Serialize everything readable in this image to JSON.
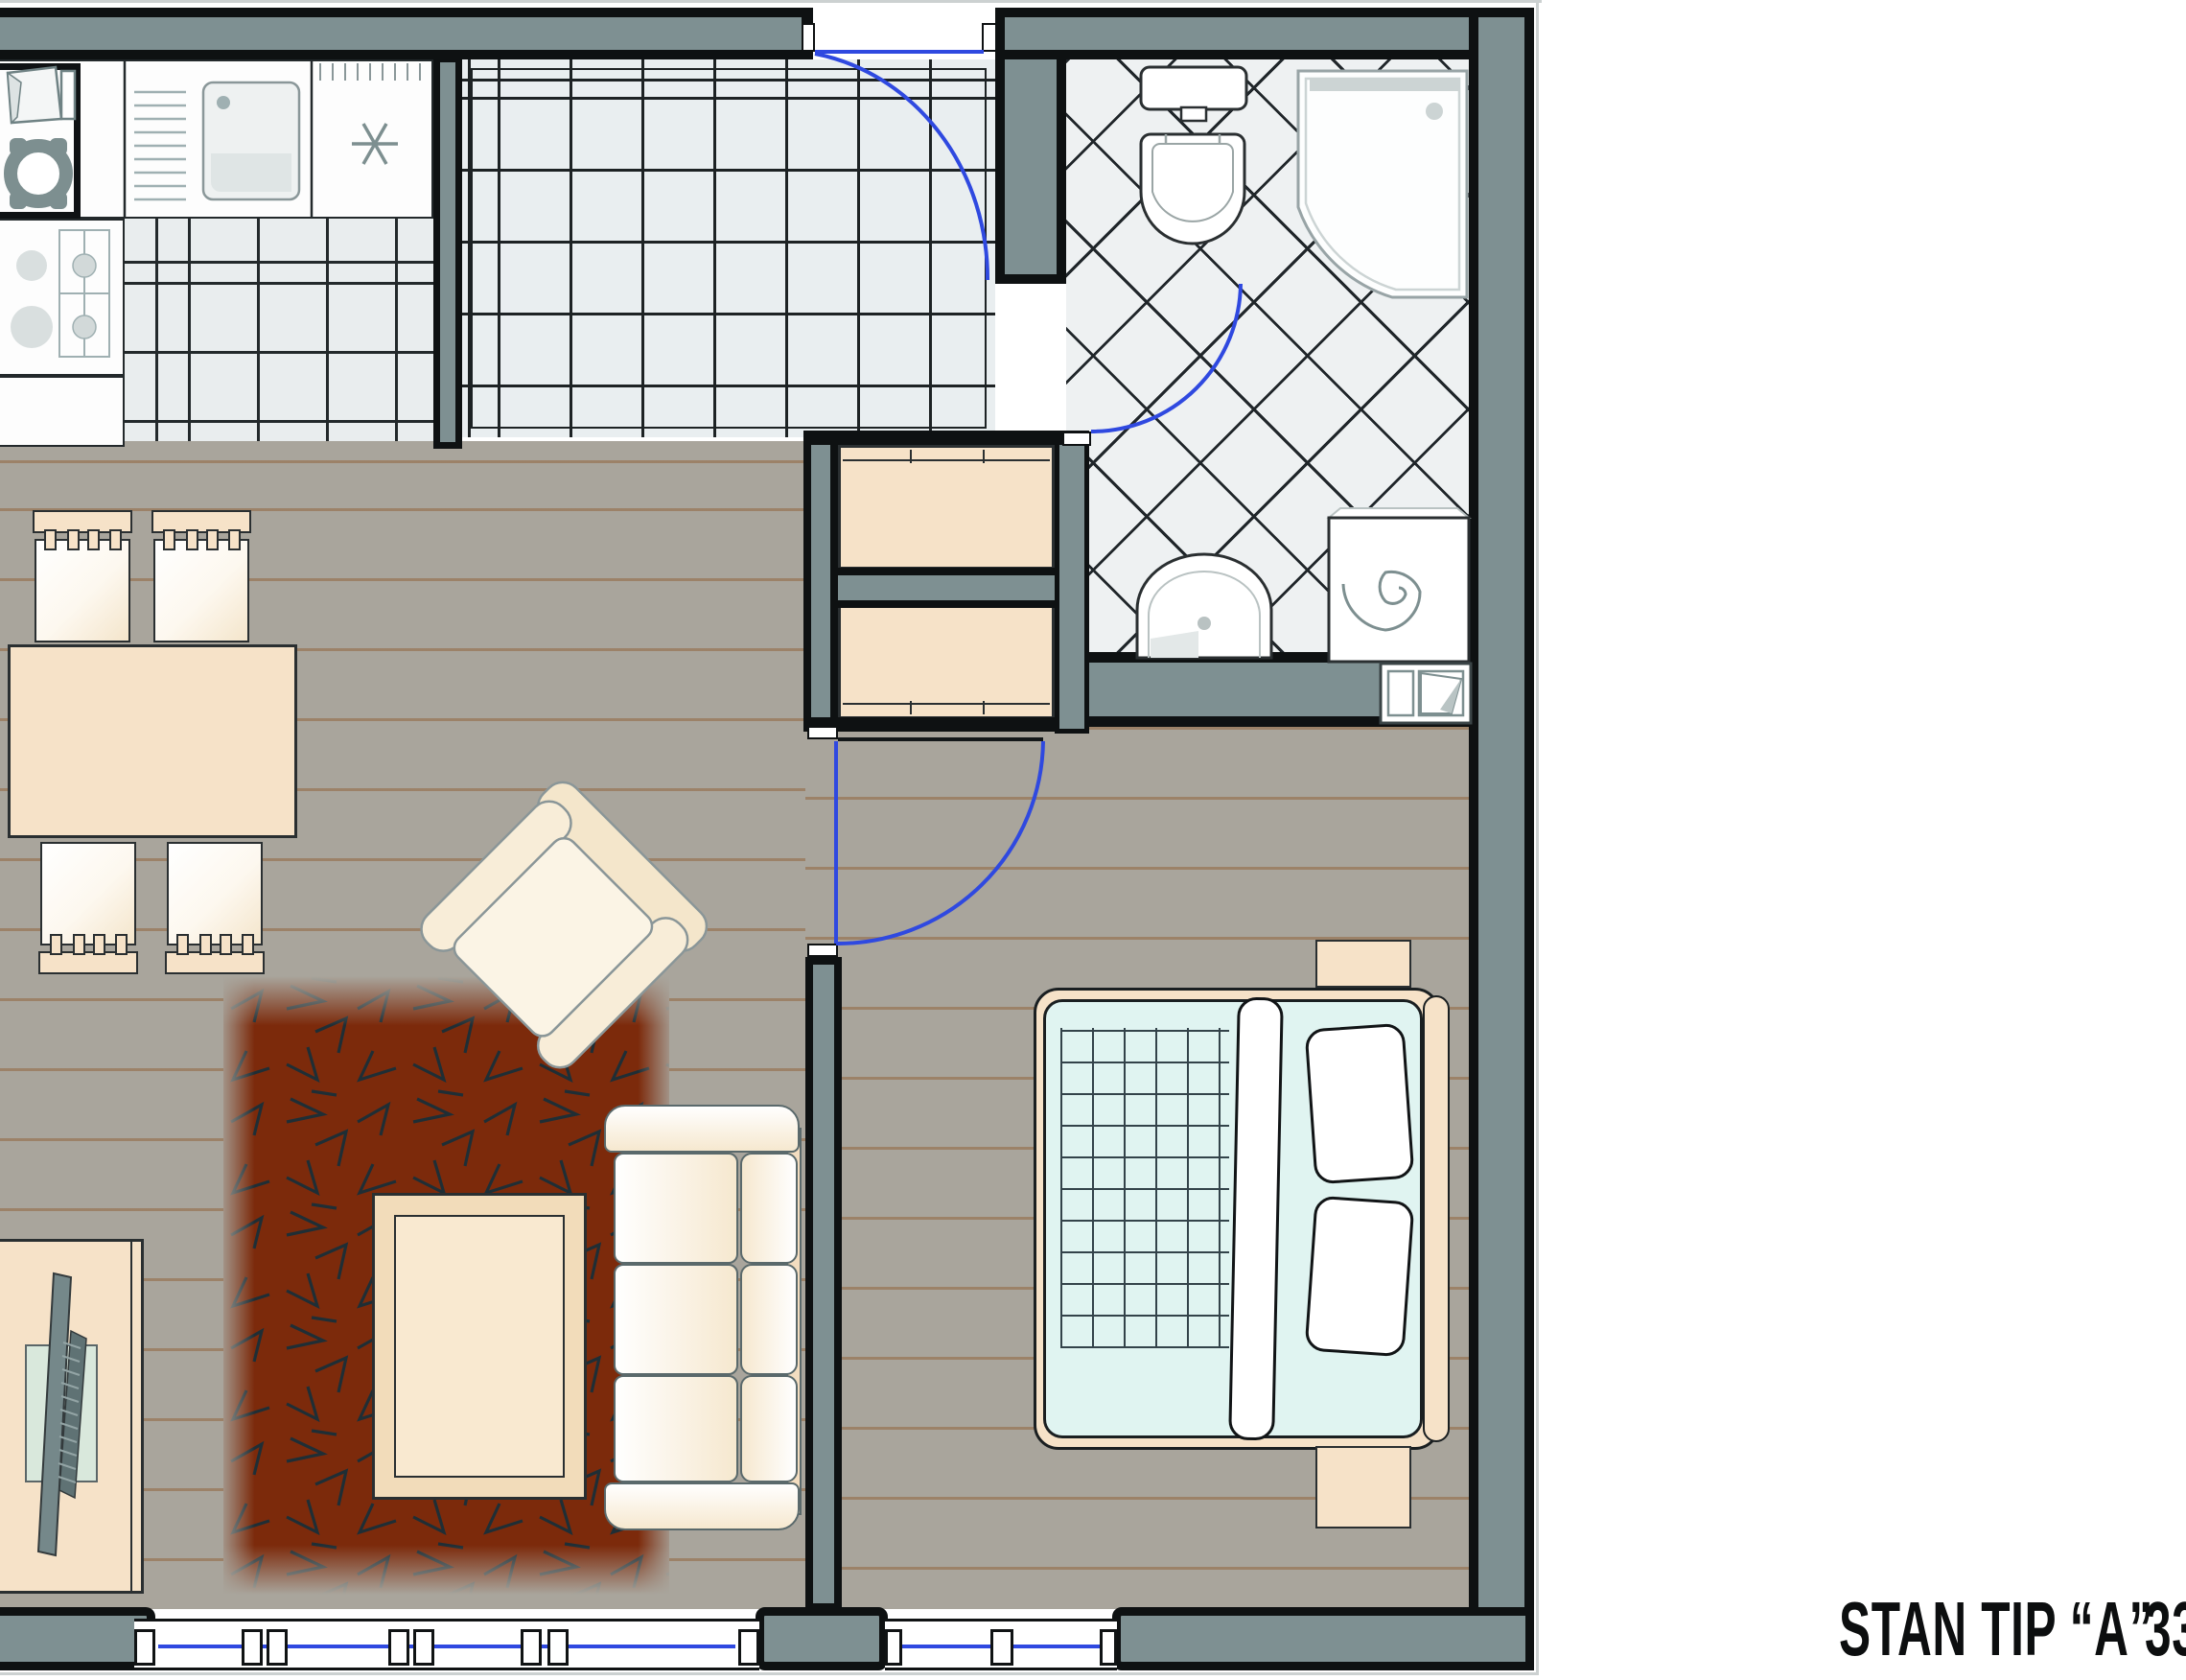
{
  "label": {
    "title": "STAN TIP “A”",
    "area_number": "33"
  },
  "palette": {
    "wall_core": "#7e9092",
    "wall_outline": "#0e1112",
    "hall_tile": "#e9eef0",
    "bath_tile": "#eef1f2",
    "wood_floor": "#a9a59c",
    "furniture_peach": "#f6e2c8",
    "upholstery_cream": "#f6ead2",
    "rug_red": "#7c2a0b",
    "bed_linen_cyan": "#e0f4f1",
    "door_swing_blue": "#2f49e0",
    "window_glass_blue": "#2f49e0",
    "appliance_gray": "#7d8f90"
  }
}
